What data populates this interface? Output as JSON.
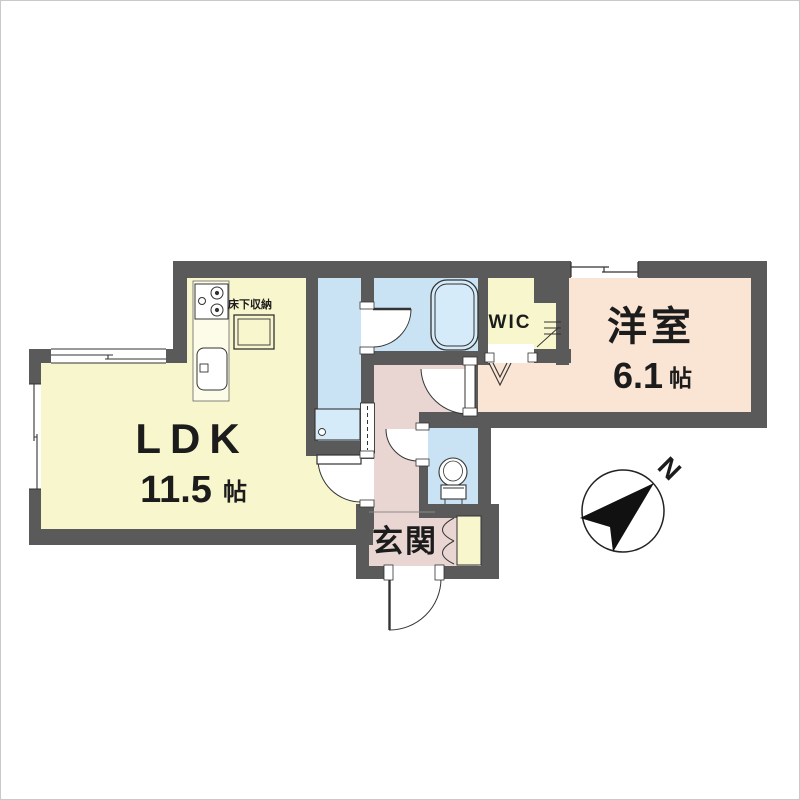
{
  "floorplan": {
    "rooms": {
      "ldk": {
        "name": "LDK",
        "size": "11.5",
        "unit": "帖"
      },
      "western_room": {
        "name": "洋室",
        "size": "6.1",
        "unit": "帖"
      },
      "wic": {
        "name": "WIC"
      },
      "entrance": {
        "name": "玄関"
      },
      "underfloor_storage": {
        "name": "床下収納"
      }
    },
    "compass": {
      "north": "N"
    },
    "colors": {
      "wall": "#5a5a5a",
      "ldk_floor": "#f8f6cd",
      "water_floor": "#c9e3f4",
      "tub_fill": "#d6ebfa",
      "hall_floor": "#e9d6d2",
      "western_floor": "#fae4d3",
      "counter": "#fcfce8",
      "text": "#1c1c1c"
    }
  }
}
